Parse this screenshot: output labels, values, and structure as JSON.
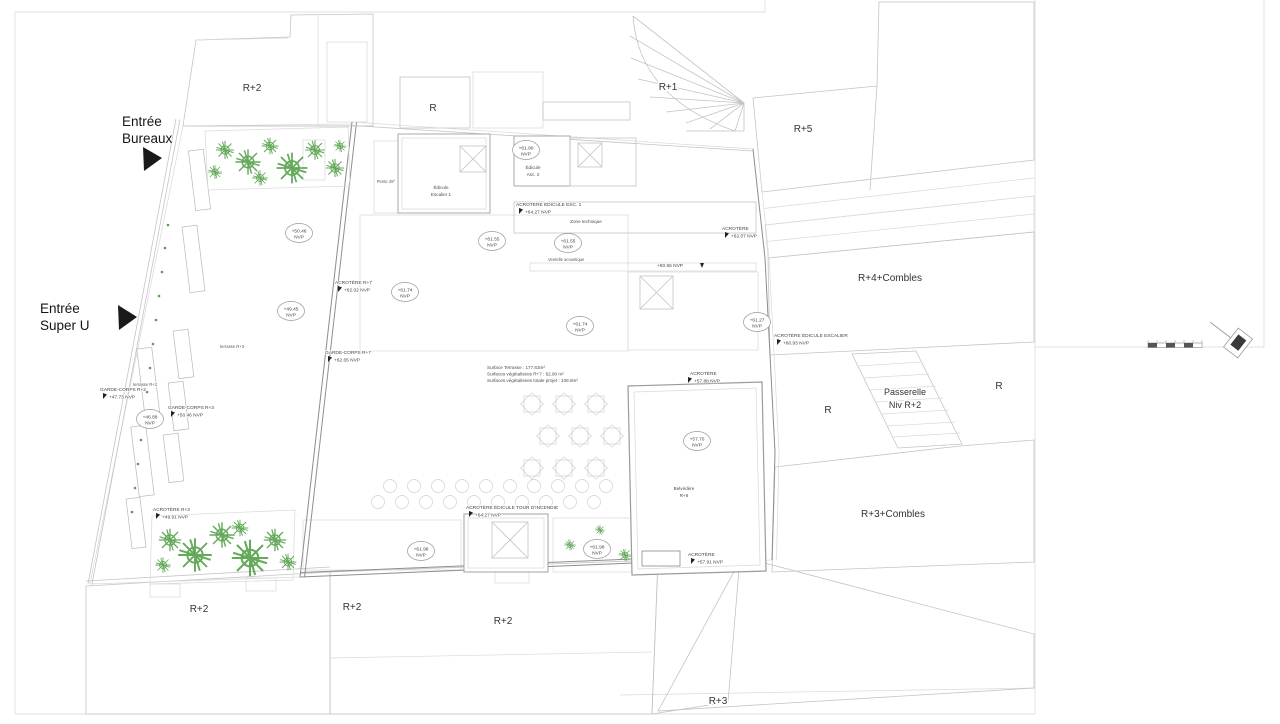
{
  "labels": {
    "r2_nw": "R+2",
    "r_top": "R",
    "r1": "R+1",
    "r5": "R+5",
    "r4_combles": "R+4+Combles",
    "r_left": "R",
    "r_right": "R",
    "passerelle_l1": "Passerelle",
    "passerelle_l2": "Niv R+2",
    "r3_combles": "R+3+Combles",
    "r2_sw": "R+2",
    "r2_s1": "R+2",
    "r2_s2": "R+2",
    "r3_se": "R+3"
  },
  "entrances": {
    "bureaux_l1": "Entrée",
    "bureaux_l2": "Bureaux",
    "superu_l1": "Entrée",
    "superu_l2": "Super U"
  },
  "level_markers": [
    {
      "value": "+61.90",
      "unit": "NVP"
    },
    {
      "value": "+50.46",
      "unit": "NVP"
    },
    {
      "value": "+61.55",
      "unit": "NVP"
    },
    {
      "value": "+61.55",
      "unit": "NVP"
    },
    {
      "value": "+49.45",
      "unit": "NVP"
    },
    {
      "value": "+61.74",
      "unit": "NVP"
    },
    {
      "value": "+61.74",
      "unit": "NVP"
    },
    {
      "value": "+61.27",
      "unit": "NVP"
    },
    {
      "value": "+46.88",
      "unit": "NVP"
    },
    {
      "value": "+57.70",
      "unit": "NVP"
    },
    {
      "value": "+61.98",
      "unit": "NVP"
    },
    {
      "value": "+61.98",
      "unit": "NVP"
    }
  ],
  "annotations": [
    {
      "title": "ACROTÈRE ÉDICULE ESC. 1",
      "value": "+64.27 NVP"
    },
    {
      "title": "ACROTÈRE R+7",
      "value": "+62.02 NVP"
    },
    {
      "title": "GARDE-CORPS R+7",
      "value": "+62.65 NVP"
    },
    {
      "title": "GARDE-CORPS R+2",
      "value": "+47.73 NVP"
    },
    {
      "title": "GARDE-CORPS R+3",
      "value": "+50.46 NVP"
    },
    {
      "title": "ACROTÈRE R+3",
      "value": "+49.91 NVP"
    },
    {
      "title": "ACROTÈRE",
      "value": "+62.07 NVP"
    },
    {
      "title": "ACROTÈRE ÉDICULE ESCALIER",
      "value": "+60.93 NVP"
    },
    {
      "title": "ACROTÈRE",
      "value": "+57.88 NVP"
    },
    {
      "title": "ACROTÈRE ÉDICULE TOUR D'INCENDIE",
      "value": "+64.27 NVP"
    },
    {
      "title": "ACROTÈRE",
      "value": "+57.91 NVP"
    },
    {
      "title": "",
      "value": "+60.55 NVP"
    }
  ],
  "structures": {
    "edicule_esc1_l1": "Édicule",
    "edicule_esc1_l2": "Escalier 1",
    "edicule_asc2_l1": "Édicule",
    "edicule_asc2_l2": "Asc. 2",
    "zone_technique": "Zone technique",
    "ventelle": "Ventelle acoustique",
    "belvedere_l1": "Belvédère",
    "belvedere_l2": "R+6",
    "pente": "Pente 28°",
    "terrasse_r2": "terrasse R+2",
    "terrasse_r3": "terrasse R+3"
  },
  "surfaces": {
    "line1": "Surface Terrasse : 177.63m²",
    "line2": "Surfaces végétalisées R+7 : 62.90 m²",
    "line3": "Surfaces végétalisées totale projet : 108.8m²"
  },
  "colors": {
    "line_grey": "#c4c4c4",
    "wall_grey": "#8f8f8f",
    "text_dark": "#333333",
    "vegetation_green": "#55a04a",
    "gravel_beige": "#cfc8b4"
  }
}
